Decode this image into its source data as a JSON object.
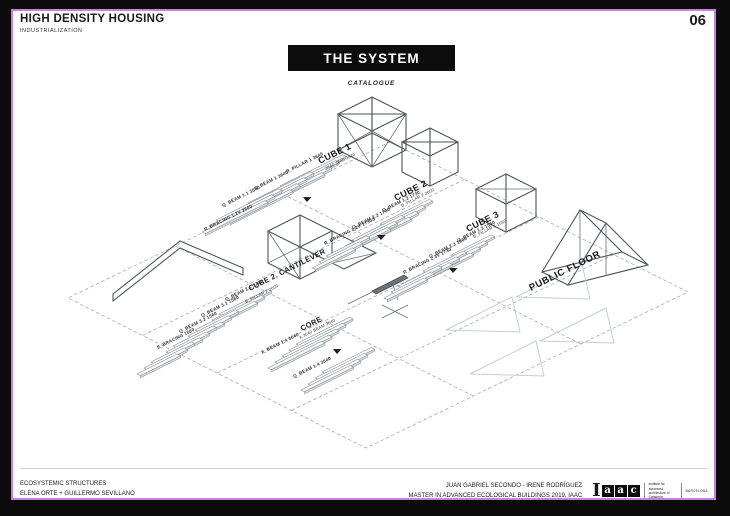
{
  "page": {
    "number": "06"
  },
  "header": {
    "title": "HIGH DENSITY HOUSING",
    "subtitle": "INDUSTRIALIZATION"
  },
  "system": {
    "title": "THE SYSTEM",
    "subtitle": "CATALOGUE"
  },
  "diagram": {
    "groups": [
      {
        "title": "CUBE 1",
        "subtitle": "3640 3640 3640",
        "parts": [
          "B_PILLAR 1 3640",
          "Q_BEAM 1 3640",
          "Q_BEAM 1.1 3640",
          "R_BRACING 1.2V 2600"
        ]
      },
      {
        "title": "CUBE 2",
        "subtitle": "B_PILLAR 2 2600",
        "parts": [
          "Q_BEAM 1.2 1730",
          "Q_BEAM 2.2 1730",
          "R_BRACING 2.2V 1730S"
        ]
      },
      {
        "title": "CUBE 3",
        "subtitle": "B_PILLAR 3 1560",
        "parts": [
          "Q_BEAM 1.3 1560",
          "Q_BEAM 2.3 1560",
          "R_BRACING 2.3V 1730"
        ]
      },
      {
        "title": "CUBE 2. CANTILEVER",
        "subtitle": "B_PILLAR 2 2600",
        "parts": [
          "Q_BEAM 2.1 1740",
          "Q_BEAM 3.1 1560",
          "Q_BEAM 3.2 1560",
          "E_BRACING 1560"
        ]
      },
      {
        "title": "CORE",
        "subtitle": "A 3640 BEAM 3640",
        "parts": [
          "A_BEAM 1.4 3640",
          "Q_BEAM 1.4 3640"
        ]
      },
      {
        "title": "PUBLIC FLOOR",
        "subtitle": "",
        "parts": []
      }
    ]
  },
  "footer": {
    "left_line1": "ECOSYSTEMIC STRUCTURES",
    "left_line2": "ELENA ORTE + GUILLERMO SEVILLANO",
    "right_line1": "JUAN GABRIEL SECONDO - IRENE RODRÍGUEZ",
    "right_line2": "MASTER IN ADVANCED ECOLOGICAL BUILDINGS 2019, IAAC",
    "logo": {
      "initial": "I",
      "letters": [
        "a",
        "a",
        "c"
      ],
      "org": "institute for advanced architecture of Catalonia",
      "city": "BARCELONA"
    }
  }
}
